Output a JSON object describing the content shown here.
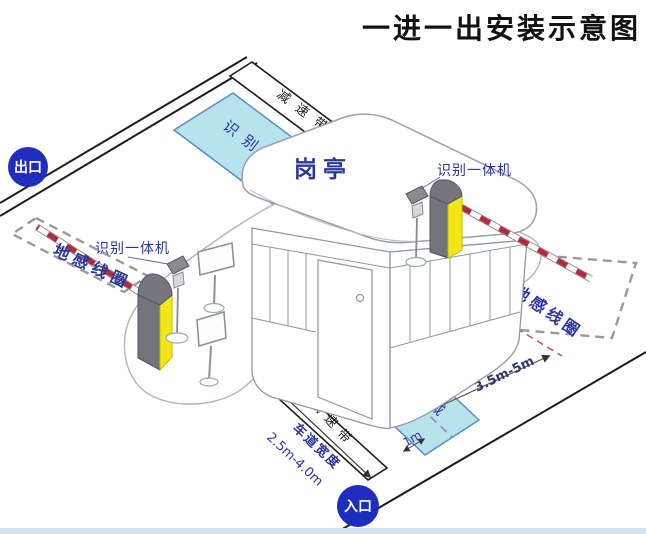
{
  "title": "一进一出安装示意图",
  "labels": {
    "exit_badge": "出口",
    "entrance_badge": "入口",
    "booth": "岗亭",
    "recognition_machine": "识别一体机",
    "ground_loop": "地感线圈",
    "recognition_area": "识别区域",
    "speed_bump": "减速带"
  },
  "dimensions": {
    "loop_distance": "3.5m-5m",
    "loop_offset": "1m",
    "lane_width_label": "车道宽度",
    "lane_width_range": "2.5m-4.0m"
  },
  "colors": {
    "badge_blue": "#1f2dbe",
    "label_navy": "#2b35a0",
    "area_fill": "#b9e2ef",
    "area_border": "#5a8fc0",
    "machine_yellow": "#f2e818",
    "machine_gray": "#73737a",
    "arm_red": "#b22b3a",
    "loop_dash_gray": "#9a9a9a",
    "title_black": "#111111"
  },
  "icons": [
    {
      "name": "barrier-gate-machine"
    },
    {
      "name": "license-plate-camera-pole"
    },
    {
      "name": "led-display-board"
    },
    {
      "name": "guard-booth"
    }
  ]
}
